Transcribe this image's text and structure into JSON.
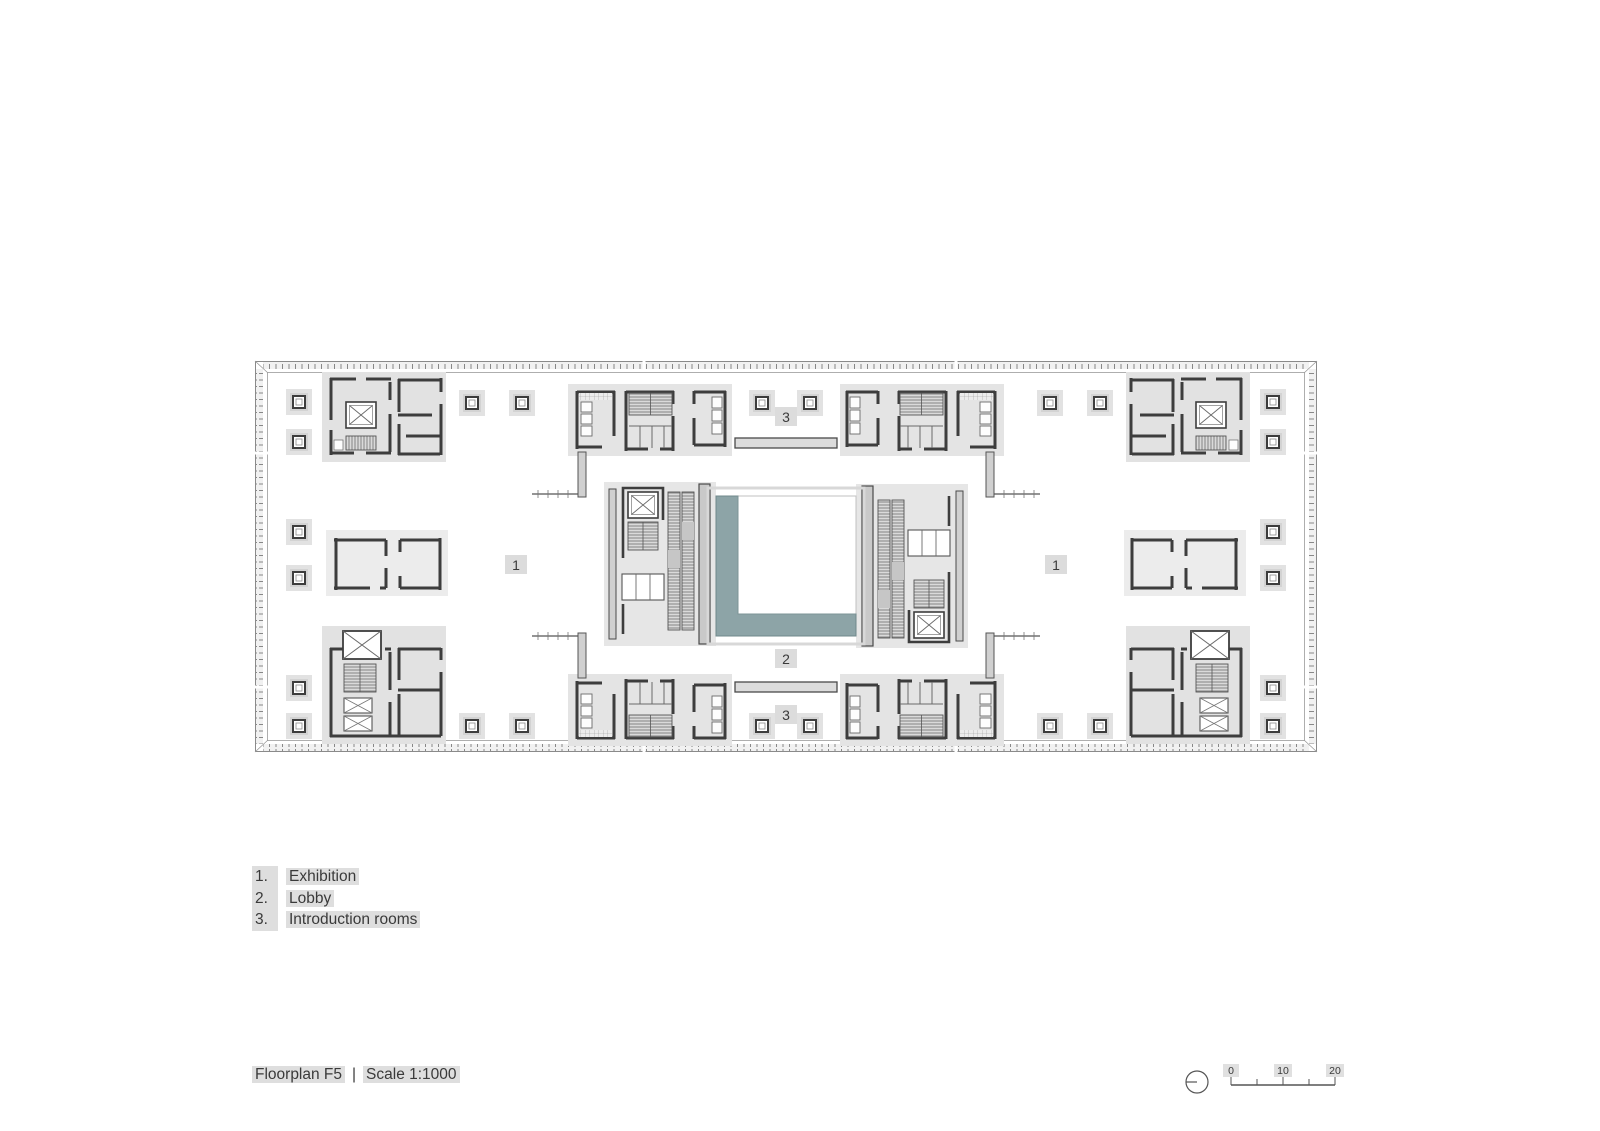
{
  "plan": {
    "labels": {
      "exhibition": "1",
      "lobby": "2",
      "introduction": "3"
    }
  },
  "legend": {
    "items": [
      {
        "number": "1.",
        "label": "Exhibition"
      },
      {
        "number": "2.",
        "label": "Lobby"
      },
      {
        "number": "3.",
        "label": "Introduction rooms"
      }
    ]
  },
  "footer": {
    "title": "Floorplan F5",
    "separator": "|",
    "scale": "Scale 1:1000"
  },
  "scalebar": {
    "labels": [
      "0",
      "10",
      "20"
    ]
  },
  "colors": {
    "teal": "#8da4a7",
    "wall": "#3d3d3d",
    "highlight": "#dcdcdc"
  }
}
